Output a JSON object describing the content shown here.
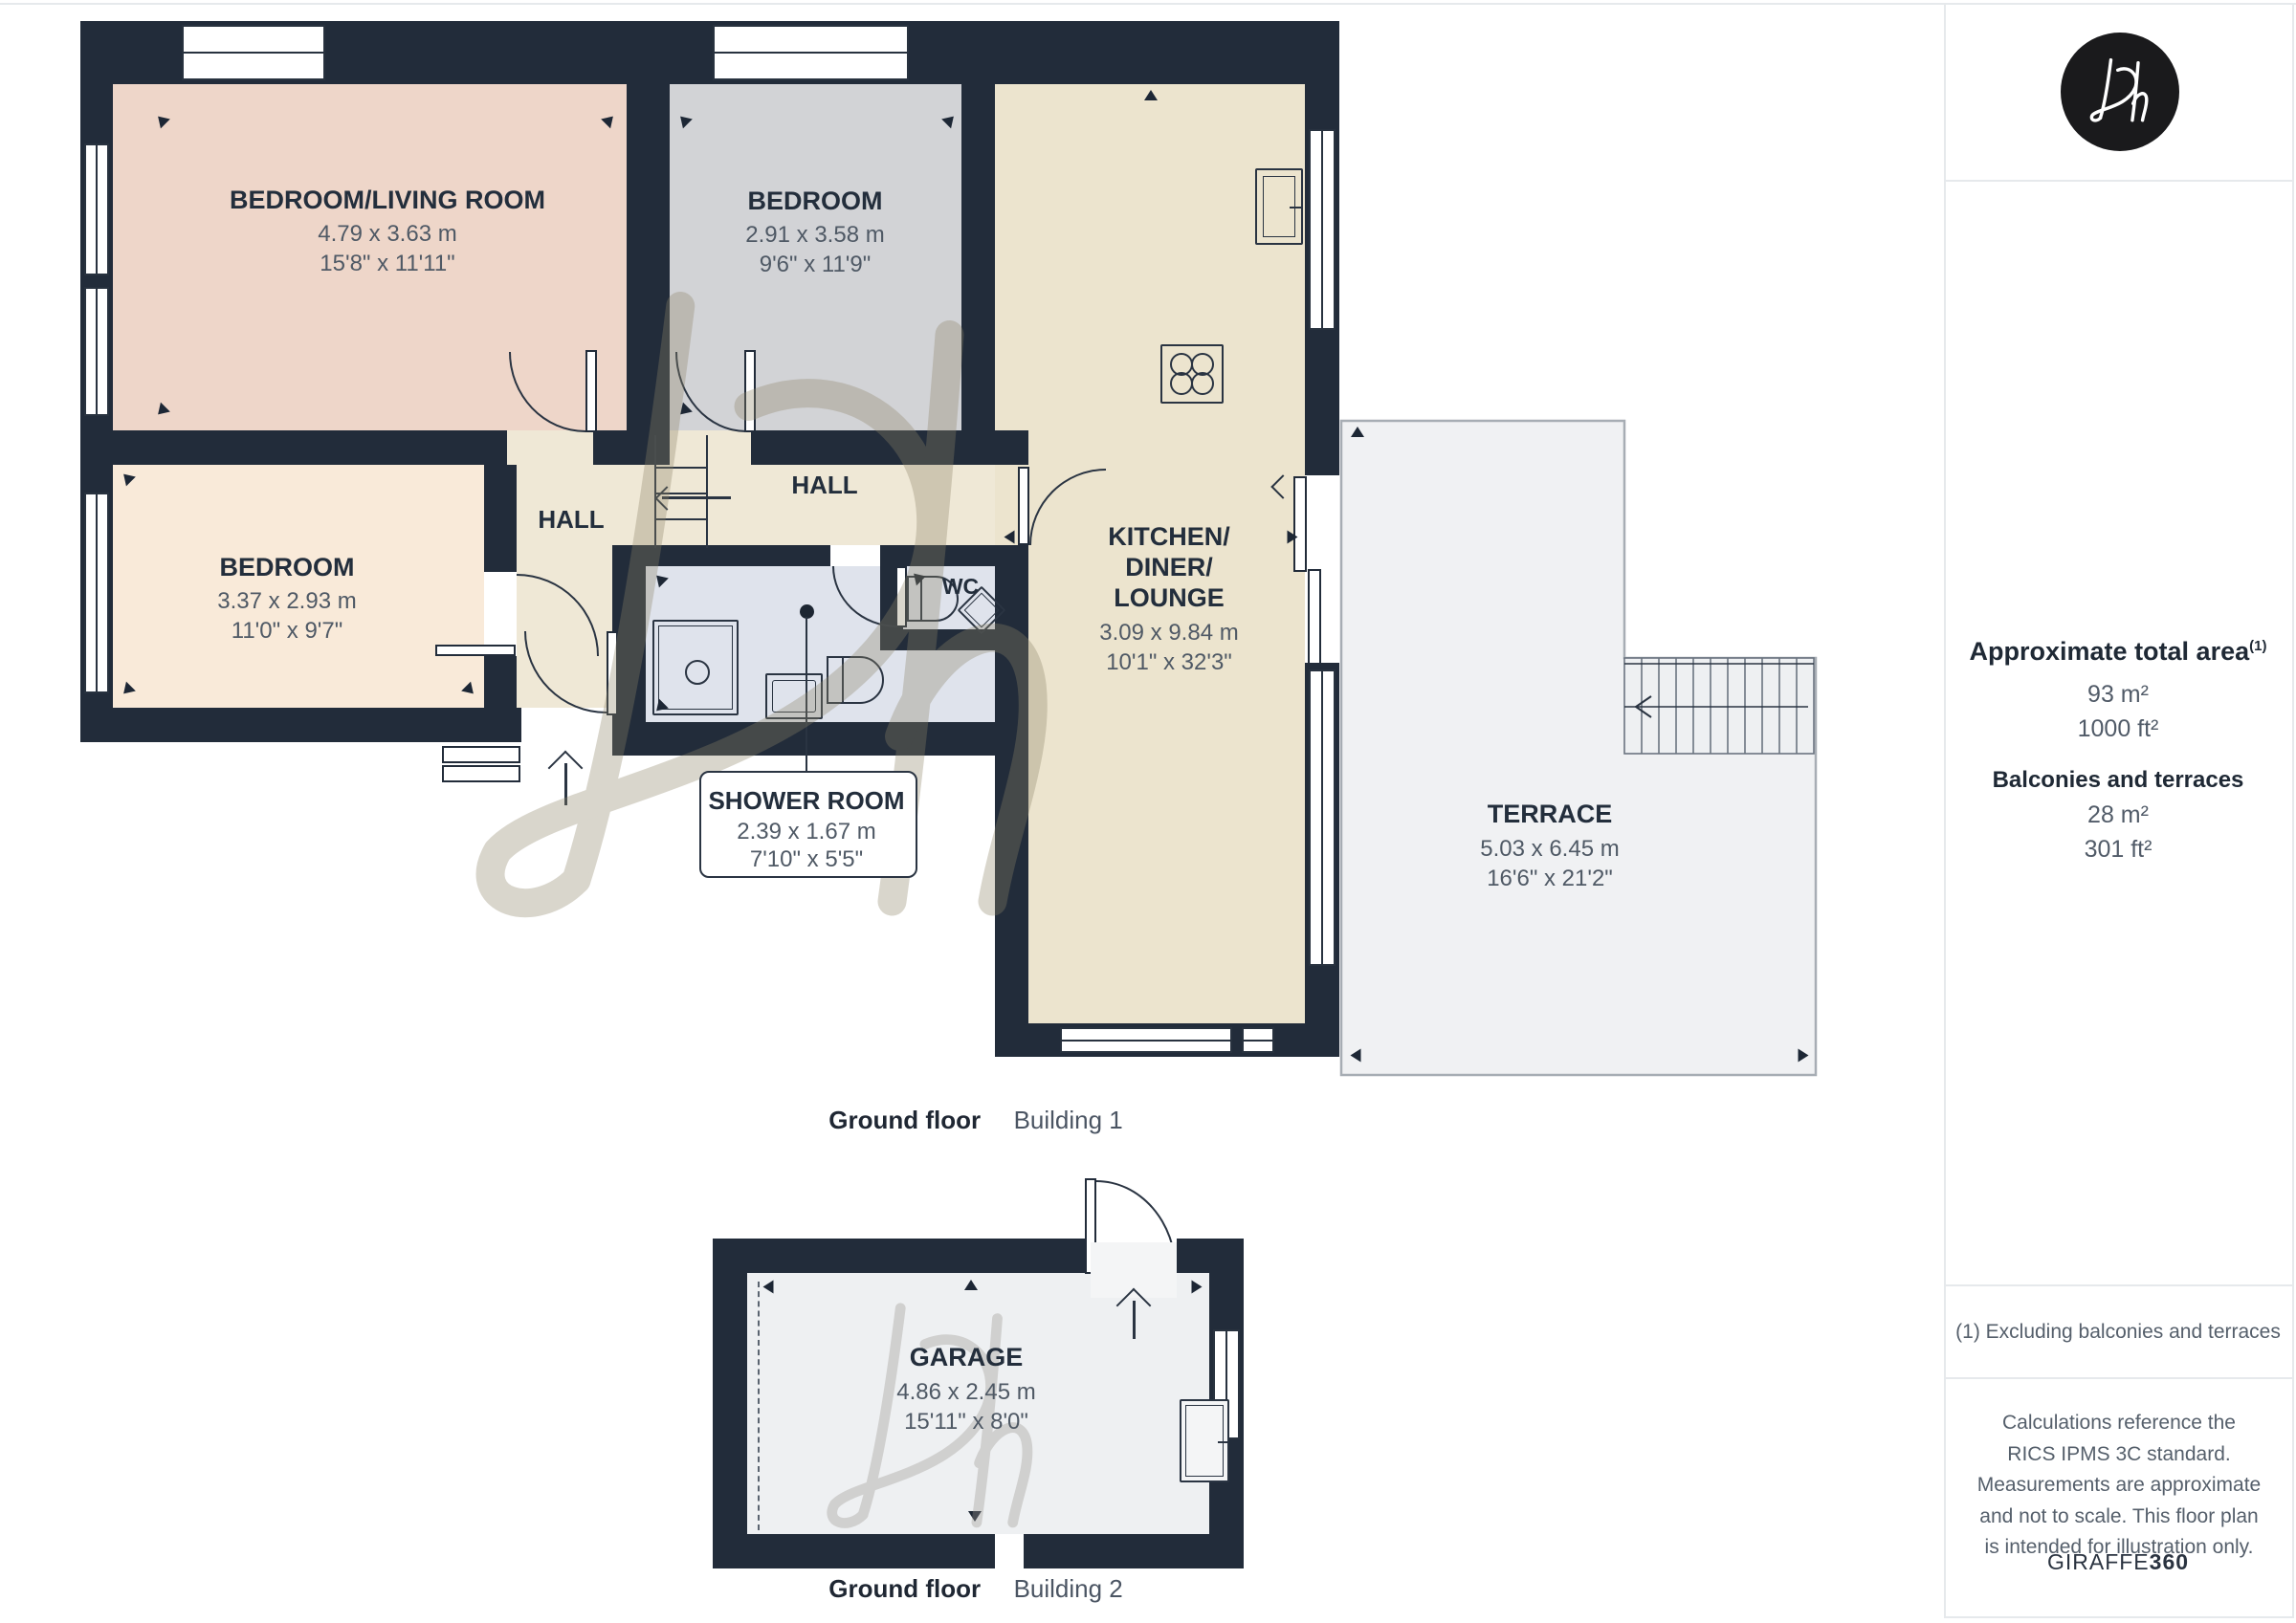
{
  "floorplan": {
    "building1": {
      "caption_bold": "Ground floor",
      "caption_regular": "Building 1",
      "rooms": {
        "bedroom_living": {
          "name": "BEDROOM/LIVING ROOM",
          "metric": "4.79 x 3.63 m",
          "imperial": "15'8\" x 11'11\""
        },
        "bedroom_top": {
          "name": "BEDROOM",
          "metric": "2.91 x 3.58 m",
          "imperial": "9'6\" x 11'9\""
        },
        "bedroom_left": {
          "name": "BEDROOM",
          "metric": "3.37 x 2.93 m",
          "imperial": "11'0\" x 9'7\""
        },
        "hall_left": {
          "name": "HALL"
        },
        "hall_right": {
          "name": "HALL"
        },
        "wc": {
          "name": "WC"
        },
        "kitchen": {
          "name_line1": "KITCHEN/",
          "name_line2": "DINER/",
          "name_line3": "LOUNGE",
          "metric": "3.09 x 9.84 m",
          "imperial": "10'1\" x 32'3\""
        },
        "shower": {
          "name": "SHOWER ROOM",
          "metric": "2.39 x 1.67 m",
          "imperial": "7'10\" x 5'5\""
        },
        "terrace": {
          "name": "TERRACE",
          "metric": "5.03 x 6.45 m",
          "imperial": "16'6\" x 21'2\""
        }
      }
    },
    "building2": {
      "caption_bold": "Ground floor",
      "caption_regular": "Building 2",
      "garage": {
        "name": "GARAGE",
        "metric": "4.86 x 2.45 m",
        "imperial": "15'11\" x 8'0\""
      }
    }
  },
  "sidebar": {
    "logo_text": "Dh",
    "total_area": {
      "title": "Approximate total area",
      "superscript": "(1)",
      "m2": "93 m²",
      "ft2": "1000 ft²"
    },
    "balconies": {
      "title": "Balconies and terraces",
      "m2": "28 m²",
      "ft2": "301 ft²"
    },
    "footnote": "(1) Excluding balconies and terraces",
    "disclaimer": "Calculations reference the RICS IPMS 3C standard. Measurements are approximate and not to scale. This floor plan is intended for illustration only.",
    "brand_regular": "GIRAFFE",
    "brand_bold": "360"
  },
  "colors": {
    "wall": "#222c3a",
    "bedroom_living_fill": "#eed6c9",
    "bedroom_top_fill": "#d2d3d6",
    "bedroom_left_fill": "#f9ead9",
    "hall_fill": "#efe8d6",
    "kitchen_fill": "#ece4ce",
    "wet_room_fill": "#dfe3ec",
    "terrace_fill": "#f0f1f3",
    "terrace_border": "#a7adb4",
    "label_dark": "#232e3c",
    "label_gray": "#4f5965"
  }
}
